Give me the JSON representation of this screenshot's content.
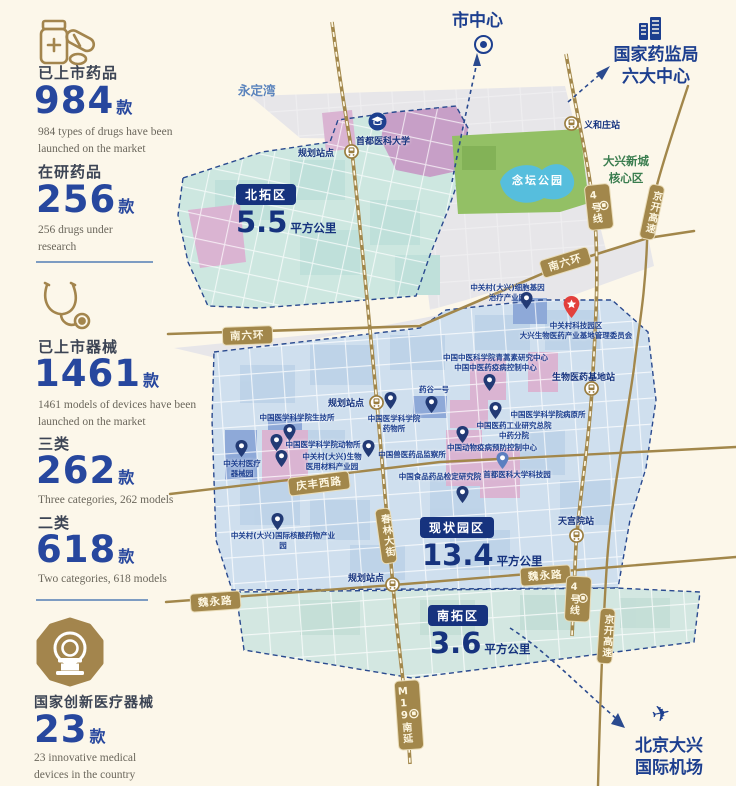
{
  "stats": {
    "sections": [
      {
        "icon": "pill-bottle-icon",
        "items": [
          {
            "label": "已上市药品",
            "value": "984",
            "unit": "款",
            "caption": "984 types of drugs have been\nlaunched on the market"
          },
          {
            "label": "在研药品",
            "value": "256",
            "unit": "款",
            "caption": "256 drugs under\nresearch"
          }
        ]
      },
      {
        "icon": "stethoscope-icon",
        "items": [
          {
            "label": "已上市器械",
            "value": "1461",
            "unit": "款",
            "caption": "1461 models of devices have been\nlaunched on the market"
          },
          {
            "label": "三类",
            "value": "262",
            "unit": "款",
            "caption": "Three categories, 262 models"
          },
          {
            "label": "二类",
            "value": "618",
            "unit": "款",
            "caption": "Two categories, 618 models"
          }
        ]
      },
      {
        "icon": "mri-scanner-icon",
        "items": [
          {
            "label": "国家创新医疗器械",
            "value": "23",
            "unit": "款",
            "caption": "23 innovative medical\ndevices in the country"
          }
        ]
      }
    ]
  },
  "map": {
    "destinations": [
      {
        "label": "市中心"
      },
      {
        "label": "国家药监局\n六大中心"
      },
      {
        "label": "北京大兴\n国际机场"
      }
    ],
    "places": [
      {
        "label": "永定湾"
      },
      {
        "label": "念坛公园"
      },
      {
        "label": "首都医科大学"
      },
      {
        "label": "大兴新城\n核心区"
      }
    ],
    "zones": [
      {
        "name": "北拓区",
        "area": "5.5",
        "unit": "平方公里"
      },
      {
        "name": "现状园区",
        "area": "13.4",
        "unit": "平方公里"
      },
      {
        "name": "南拓区",
        "area": "3.6",
        "unit": "平方公里"
      }
    ],
    "stations": [
      {
        "name": "义和庄站"
      },
      {
        "name": "规划站点"
      },
      {
        "name": "规划站点"
      },
      {
        "name": "规划站点"
      },
      {
        "name": "生物医药基地站"
      },
      {
        "name": "天宫院站"
      }
    ],
    "road_badges": [
      {
        "label": "南六环"
      },
      {
        "label": "南六环"
      },
      {
        "label": "庆丰西路"
      },
      {
        "label": "魏永路"
      },
      {
        "label": "魏永路"
      },
      {
        "label": "春林大街"
      },
      {
        "label": "4号线"
      },
      {
        "label": "4号线"
      },
      {
        "label": "M19南延"
      },
      {
        "label": "京开高速"
      },
      {
        "label": "京开高速"
      }
    ],
    "facilities": [
      {
        "label": "中关村(大兴)细胞基因\n治疗产业园"
      },
      {
        "label": "中关村科技园区\n大兴生物医药产业基地管理委员会"
      },
      {
        "label": "中国中医科学院青蒿素研究中心\n中国中医药疫病控制中心"
      },
      {
        "label": "药谷一号"
      },
      {
        "label": "中国医学科学院\n药物所"
      },
      {
        "label": "中国医学科学院生技所"
      },
      {
        "label": "中国医学科学院动物所"
      },
      {
        "label": "中关村(大兴)生物\n医用材料产业园"
      },
      {
        "label": "中关村医疗\n器械园"
      },
      {
        "label": "中国兽医药品监察所"
      },
      {
        "label": "中国动物疫病预防控制中心"
      },
      {
        "label": "中国医学科学院病原所"
      },
      {
        "label": "中国医药工业研究总院\n中药分院"
      },
      {
        "label": "首都医科大学科技园"
      },
      {
        "label": "中国食品药品检定研究院"
      },
      {
        "label": "中关村(大兴)国际核酸药物产业园"
      }
    ]
  },
  "colors": {
    "accent_navy": "#1d3f8f",
    "gold": "#a2874b",
    "cream": "#fcf7ea",
    "teal_zone": "#cde7e0",
    "blue_zone": "#cfdfee",
    "purple_zone": "#c79fc7",
    "pink_block": "#dab4d2",
    "park_green": "#93c065",
    "lake_blue": "#56bedd",
    "red_pin": "#e2403c",
    "green_text": "#3a7d4f"
  }
}
